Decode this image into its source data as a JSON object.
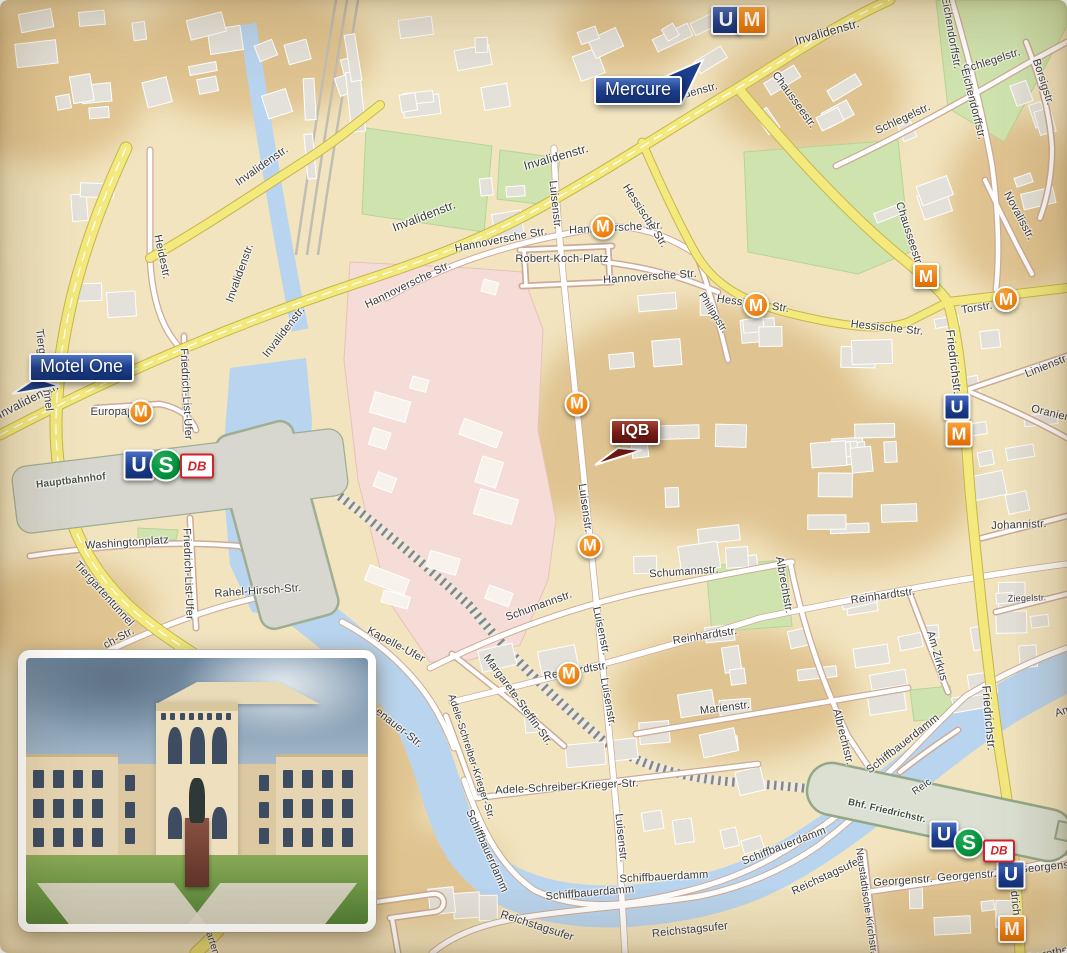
{
  "flags": [
    {
      "id": "mercure",
      "label": "Mercure",
      "color": "#1c3e8c"
    },
    {
      "id": "motel-one",
      "label": "Motel One",
      "color": "#1c3e8c"
    },
    {
      "id": "iqb",
      "label": "IQB",
      "color": "#7a1d16"
    }
  ],
  "colors": {
    "water": "#b9d4ee",
    "park": "#cfe3ae",
    "campus_pink": "#f6dcd6",
    "road_yellow": "#f3e97d",
    "u_blue": "#1c3d8f",
    "s_green": "#00913d",
    "m_orange": "#ef8514",
    "db_red": "#d2232a",
    "land": "#f1e4bf"
  },
  "street_labels": [
    {
      "t": "Invalidenstr.",
      "x": 28,
      "y": 400,
      "r": -27,
      "fs": 12
    },
    {
      "t": "Invalidenstr.",
      "x": 262,
      "y": 166,
      "r": -35,
      "fs": 11
    },
    {
      "t": "Invalidenstr.",
      "x": 240,
      "y": 273,
      "r": -70,
      "fs": 11
    },
    {
      "t": "Invalidenstr.",
      "x": 284,
      "y": 332,
      "r": -52,
      "fs": 11
    },
    {
      "t": "Invalidenstr.",
      "x": 424,
      "y": 216,
      "r": -21,
      "fs": 12
    },
    {
      "t": "Invalidenstr.",
      "x": 556,
      "y": 157,
      "r": -16,
      "fs": 12
    },
    {
      "t": "Invalidenstr.",
      "x": 688,
      "y": 94,
      "r": -15,
      "fs": 11
    },
    {
      "t": "Invalidenstr.",
      "x": 827,
      "y": 32,
      "r": -16,
      "fs": 12
    },
    {
      "t": "Heidestr.",
      "x": 162,
      "y": 257,
      "r": 78,
      "fs": 11
    },
    {
      "t": "Tiergartentunnel",
      "x": 44,
      "y": 370,
      "r": 83,
      "fs": 11
    },
    {
      "t": "Tiergartentunnel",
      "x": 104,
      "y": 594,
      "r": 48,
      "fs": 11
    },
    {
      "t": "Tiergartentunnel",
      "x": 213,
      "y": 946,
      "r": 72,
      "fs": 10
    },
    {
      "t": "Europaplatz",
      "x": 121,
      "y": 412,
      "r": 0,
      "fs": 11
    },
    {
      "t": "Hauptbahnhof",
      "x": 71,
      "y": 481,
      "r": -7,
      "fs": 10,
      "b": 1,
      "c": "#49544a"
    },
    {
      "t": "Washingtonplatz",
      "x": 127,
      "y": 543,
      "r": -4,
      "fs": 11
    },
    {
      "t": "Friedrich-List-Ufer",
      "x": 186,
      "y": 394,
      "r": 87,
      "fs": 11
    },
    {
      "t": "Friedrich-List-Ufer",
      "x": 188,
      "y": 574,
      "r": 88,
      "fs": 11
    },
    {
      "t": "Rahel-Hirsch-Str.",
      "x": 258,
      "y": 591,
      "r": -4,
      "fs": 11
    },
    {
      "t": "ch-Str.",
      "x": 119,
      "y": 638,
      "r": -28,
      "fs": 11
    },
    {
      "t": "Kapelle-Ufer",
      "x": 396,
      "y": 645,
      "r": 28,
      "fs": 11
    },
    {
      "t": "enauer-Str.",
      "x": 399,
      "y": 728,
      "r": 38,
      "fs": 11
    },
    {
      "t": "Margarete-Steffin-Str.",
      "x": 518,
      "y": 700,
      "r": 54,
      "fs": 11
    },
    {
      "t": "Adele-Schreiber-Krieger-Str.",
      "x": 471,
      "y": 757,
      "r": 72,
      "fs": 10
    },
    {
      "t": "Adele-Schreiber-Krieger-Str.",
      "x": 567,
      "y": 787,
      "r": -3,
      "fs": 11
    },
    {
      "t": "Schumannstr.",
      "x": 539,
      "y": 606,
      "r": -20,
      "fs": 11
    },
    {
      "t": "Schumannstr.",
      "x": 684,
      "y": 572,
      "r": -4,
      "fs": 11
    },
    {
      "t": "Reinhardtstr.",
      "x": 576,
      "y": 671,
      "r": -10,
      "fs": 11
    },
    {
      "t": "Reinhardtstr.",
      "x": 705,
      "y": 636,
      "r": -9,
      "fs": 11
    },
    {
      "t": "Reinhardtstr.",
      "x": 883,
      "y": 596,
      "r": -8,
      "fs": 11
    },
    {
      "t": "Marienstr.",
      "x": 725,
      "y": 708,
      "r": -7,
      "fs": 11
    },
    {
      "t": "Luisenstr.",
      "x": 555,
      "y": 205,
      "r": 84,
      "fs": 11
    },
    {
      "t": "Luisenstr.",
      "x": 585,
      "y": 508,
      "r": 82,
      "fs": 11
    },
    {
      "t": "Luisenstr.",
      "x": 601,
      "y": 631,
      "r": 78,
      "fs": 11
    },
    {
      "t": "Luisenstr.",
      "x": 608,
      "y": 702,
      "r": 80,
      "fs": 11
    },
    {
      "t": "Luisenstr.",
      "x": 621,
      "y": 838,
      "r": 84,
      "fs": 11
    },
    {
      "t": "Hannoversche Str.",
      "x": 408,
      "y": 285,
      "r": -26,
      "fs": 11
    },
    {
      "t": "Hannoversche Str.",
      "x": 501,
      "y": 240,
      "r": -11,
      "fs": 11
    },
    {
      "t": "Hannoversche Str.",
      "x": 616,
      "y": 228,
      "r": -3,
      "fs": 11
    },
    {
      "t": "Hannoversche Str.",
      "x": 650,
      "y": 277,
      "r": -4,
      "fs": 11
    },
    {
      "t": "Robert-Koch-Platz",
      "x": 562,
      "y": 259,
      "r": 0,
      "fs": 11
    },
    {
      "t": "Hessische Str.",
      "x": 645,
      "y": 216,
      "r": 57,
      "fs": 11
    },
    {
      "t": "Hessische Str.",
      "x": 753,
      "y": 304,
      "r": 8,
      "fs": 11
    },
    {
      "t": "Hessische Str.",
      "x": 887,
      "y": 328,
      "r": 6,
      "fs": 11
    },
    {
      "t": "Philippstr.",
      "x": 713,
      "y": 313,
      "r": 58,
      "fs": 10
    },
    {
      "t": "Chausseestr.",
      "x": 794,
      "y": 100,
      "r": 54,
      "fs": 11
    },
    {
      "t": "Chausseestr.",
      "x": 909,
      "y": 234,
      "r": 72,
      "fs": 11
    },
    {
      "t": "Torstr.",
      "x": 977,
      "y": 308,
      "r": -9,
      "fs": 11
    },
    {
      "t": "Schlegelstr.",
      "x": 903,
      "y": 119,
      "r": -25,
      "fs": 11
    },
    {
      "t": "Schlegelstr.",
      "x": 992,
      "y": 61,
      "r": -18,
      "fs": 11
    },
    {
      "t": "Eichendorffstr.",
      "x": 951,
      "y": 33,
      "r": 80,
      "fs": 11
    },
    {
      "t": "Eichendorffstr.",
      "x": 973,
      "y": 104,
      "r": 76,
      "fs": 11
    },
    {
      "t": "Borsigstr.",
      "x": 1043,
      "y": 82,
      "r": 72,
      "fs": 11
    },
    {
      "t": "Novalisstr.",
      "x": 1019,
      "y": 216,
      "r": 62,
      "fs": 11
    },
    {
      "t": "Friedrichstr.",
      "x": 954,
      "y": 362,
      "r": 83,
      "fs": 12
    },
    {
      "t": "Friedrichstr.",
      "x": 989,
      "y": 718,
      "r": 85,
      "fs": 12
    },
    {
      "t": "Friedrichstr.",
      "x": 1015,
      "y": 901,
      "r": 84,
      "fs": 11
    },
    {
      "t": "Linienstr.",
      "x": 1047,
      "y": 366,
      "r": -22,
      "fs": 11
    },
    {
      "t": "Oranienburger Str.",
      "x": 1077,
      "y": 420,
      "r": 14,
      "fs": 11
    },
    {
      "t": "Johannistr.",
      "x": 1019,
      "y": 525,
      "r": -2,
      "fs": 11
    },
    {
      "t": "Ziegelstr.",
      "x": 1027,
      "y": 598,
      "r": -2,
      "fs": 9
    },
    {
      "t": "Am Zirkus",
      "x": 937,
      "y": 656,
      "r": 74,
      "fs": 11
    },
    {
      "t": "Albrechtstr.",
      "x": 784,
      "y": 585,
      "r": 80,
      "fs": 11
    },
    {
      "t": "Albrechtstr.",
      "x": 843,
      "y": 737,
      "r": 76,
      "fs": 11
    },
    {
      "t": "Am Weidendamm",
      "x": 1098,
      "y": 700,
      "r": -18,
      "fs": 11
    },
    {
      "t": "Schiffbauerdamm",
      "x": 487,
      "y": 851,
      "r": 66,
      "fs": 11
    },
    {
      "t": "Schiffbauerdamm",
      "x": 590,
      "y": 893,
      "r": -5,
      "fs": 11
    },
    {
      "t": "Schiffbauerdamm",
      "x": 664,
      "y": 877,
      "r": -3,
      "fs": 11
    },
    {
      "t": "Schiffbauerdamm",
      "x": 784,
      "y": 846,
      "r": -21,
      "fs": 11
    },
    {
      "t": "Schiffbauerdamm",
      "x": 903,
      "y": 744,
      "r": -38,
      "fs": 11
    },
    {
      "t": "Reichstagsufer",
      "x": 537,
      "y": 926,
      "r": 18,
      "fs": 11
    },
    {
      "t": "Reichstagsufer",
      "x": 690,
      "y": 930,
      "r": -6,
      "fs": 11
    },
    {
      "t": "Reichstagsufer",
      "x": 827,
      "y": 876,
      "r": -25,
      "fs": 11
    },
    {
      "t": "Reic",
      "x": 922,
      "y": 787,
      "r": -35,
      "fs": 10
    },
    {
      "t": "Georgenstr.",
      "x": 903,
      "y": 881,
      "r": -4,
      "fs": 11
    },
    {
      "t": "Georgenstr.",
      "x": 967,
      "y": 876,
      "r": -4,
      "fs": 11
    },
    {
      "t": "Georgenstr.",
      "x": 1049,
      "y": 867,
      "r": -6,
      "fs": 11
    },
    {
      "t": "Neustädtische Kirchstr.",
      "x": 866,
      "y": 901,
      "r": 82,
      "fs": 10
    },
    {
      "t": "Bhf. Friedrichstr.",
      "x": 887,
      "y": 811,
      "r": 13,
      "fs": 9.5,
      "b": 1,
      "c": "#3e4e3e"
    },
    {
      "t": "Dorotheenstr.",
      "x": 1062,
      "y": 951,
      "r": -12,
      "fs": 11
    }
  ],
  "transit_icons": [
    {
      "type": "u",
      "label": "U",
      "x": 726,
      "y": 20,
      "s": 26
    },
    {
      "type": "m-square",
      "label": "M",
      "x": 752,
      "y": 20,
      "s": 26
    },
    {
      "type": "u",
      "label": "U",
      "x": 957,
      "y": 407,
      "s": 23
    },
    {
      "type": "m-square",
      "label": "M",
      "x": 959,
      "y": 434,
      "s": 23
    },
    {
      "type": "m-square",
      "label": "M",
      "x": 926,
      "y": 276,
      "s": 22
    },
    {
      "type": "u",
      "label": "U",
      "x": 1011,
      "y": 875,
      "s": 25
    },
    {
      "type": "m-square",
      "label": "M",
      "x": 1012,
      "y": 929,
      "s": 24
    },
    {
      "type": "u",
      "label": "U",
      "x": 139,
      "y": 465,
      "s": 27
    },
    {
      "type": "s",
      "label": "S",
      "x": 166,
      "y": 465,
      "s": 29
    },
    {
      "type": "db",
      "label": "DB",
      "x": 197,
      "y": 466,
      "w": 30,
      "h": 21
    },
    {
      "type": "u",
      "label": "U",
      "x": 944,
      "y": 835,
      "s": 25
    },
    {
      "type": "s",
      "label": "S",
      "x": 969,
      "y": 843,
      "s": 27
    },
    {
      "type": "db",
      "label": "DB",
      "x": 999,
      "y": 851,
      "w": 28,
      "h": 19
    },
    {
      "type": "m-circle",
      "label": "M",
      "x": 603,
      "y": 227,
      "s": 21
    },
    {
      "type": "m-circle",
      "label": "M",
      "x": 756,
      "y": 305,
      "s": 22
    },
    {
      "type": "m-circle",
      "label": "M",
      "x": 1006,
      "y": 299,
      "s": 22
    },
    {
      "type": "m-circle",
      "label": "M",
      "x": 141,
      "y": 412,
      "s": 21
    },
    {
      "type": "m-circle",
      "label": "M",
      "x": 577,
      "y": 404,
      "s": 21
    },
    {
      "type": "m-circle",
      "label": "M",
      "x": 590,
      "y": 546,
      "s": 21
    },
    {
      "type": "m-circle",
      "label": "M",
      "x": 569,
      "y": 674,
      "s": 21
    }
  ]
}
